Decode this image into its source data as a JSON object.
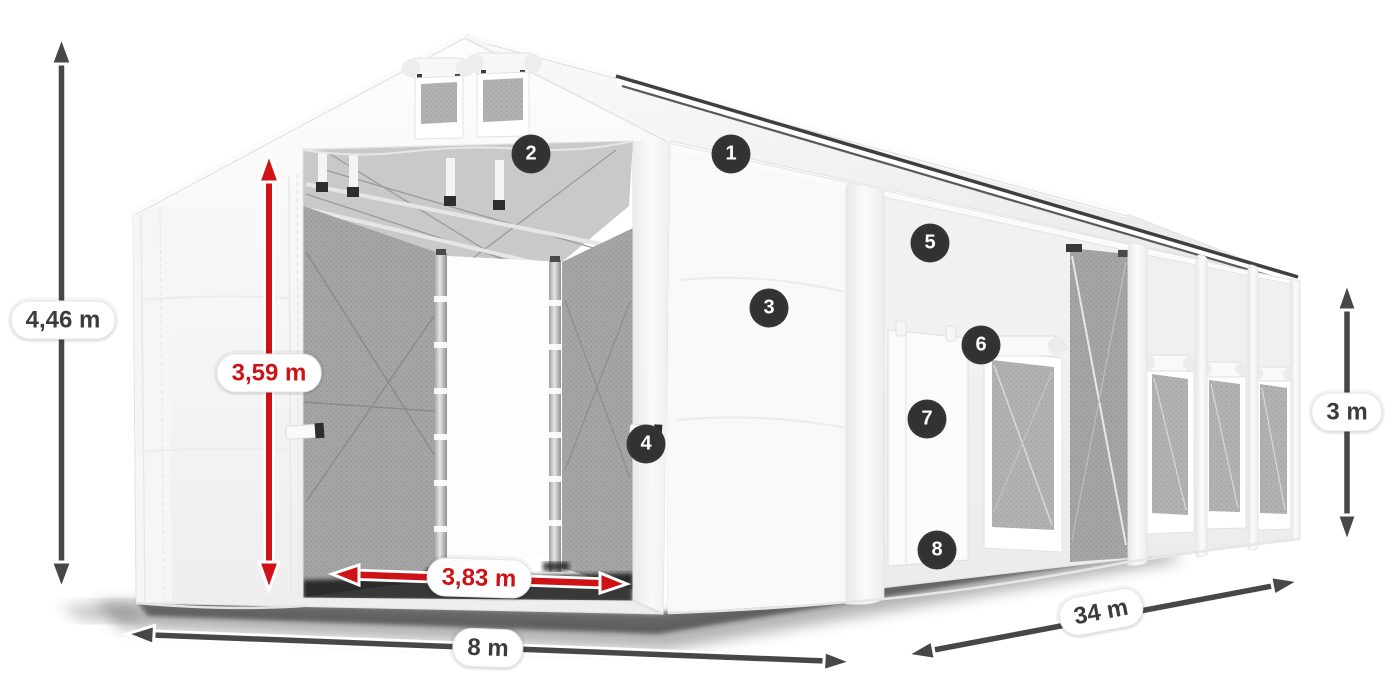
{
  "figure": {
    "type": "annotated-product-illustration",
    "subject": "white storage tent hall with open front entrance, side door and mesh windows"
  },
  "dimensions": {
    "total_height": "4,46 m",
    "entrance_height": "3,59 m",
    "entrance_width": "3,83 m",
    "width": "8 m",
    "length": "34 m",
    "side_wall_height": "3 m"
  },
  "hotspots": [
    {
      "number": "1"
    },
    {
      "number": "2"
    },
    {
      "number": "3"
    },
    {
      "number": "4"
    },
    {
      "number": "5"
    },
    {
      "number": "6"
    },
    {
      "number": "7"
    },
    {
      "number": "8"
    }
  ],
  "colors": {
    "accent_red": "#cd1316",
    "arrow_dark": "#474747",
    "badge_background": "#323232",
    "label_background": "#ffffff",
    "fabric_white": "#f7f7f7",
    "mesh_gray": "#b2b2b2"
  }
}
